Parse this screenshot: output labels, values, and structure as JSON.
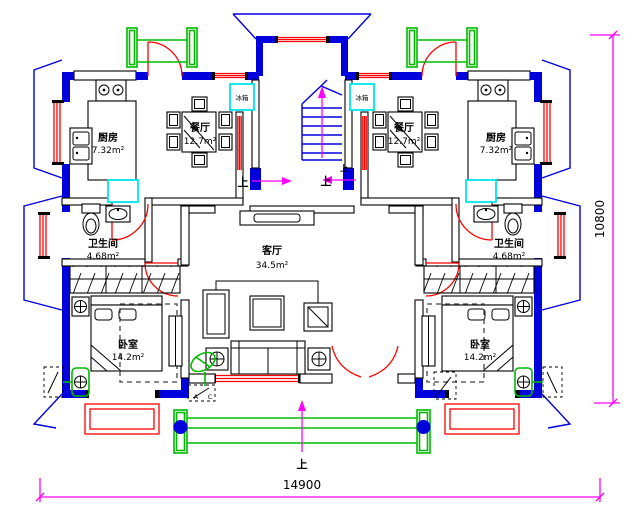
{
  "rooms": {
    "kitchen_left": {
      "name": "厨房",
      "area": "7.32m²"
    },
    "dining_left": {
      "name": "餐厅",
      "area": "12.7m²"
    },
    "bathroom_left": {
      "name": "卫生间",
      "area": "4.68m²"
    },
    "bedroom_left": {
      "name": "卧室",
      "area": "14.2m²"
    },
    "living": {
      "name": "客厅",
      "area": "34.5m²"
    },
    "kitchen_right": {
      "name": "厨房",
      "area": "7.32m²"
    },
    "dining_right": {
      "name": "餐厅",
      "area": "12.7m²"
    },
    "bathroom_right": {
      "name": "卫生间",
      "area": "4.68m²"
    },
    "bedroom_right": {
      "name": "卧室",
      "area": "14.2m²"
    }
  },
  "appliances": {
    "fridge_left": "冰箱",
    "fridge_right": "冰箱"
  },
  "directions": {
    "up_corridor_left": "上",
    "up_corridor_right": "上",
    "up_stair": "上",
    "up_porch": "上"
  },
  "dimensions": {
    "width": "14900",
    "height": "10800"
  },
  "ac_unit": {
    "letter_a": "A",
    "letter_c": "C"
  },
  "colors": {
    "wall": "#0000dd",
    "window_door": "#ff0000",
    "landscape": "#00bb00",
    "appliance": "#00e5ee",
    "dimension": "#ff00ff"
  }
}
